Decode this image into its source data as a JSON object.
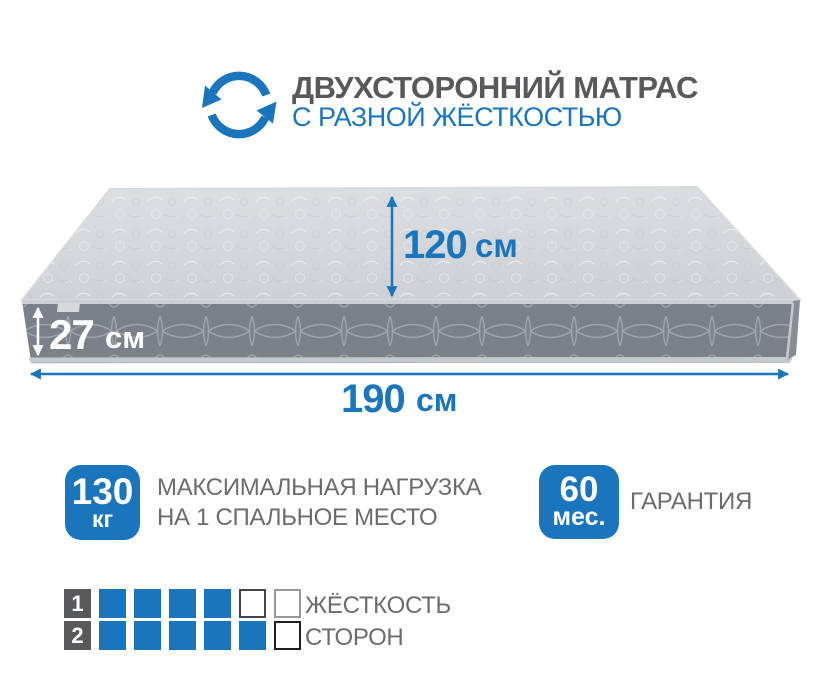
{
  "colors": {
    "accent_blue": "#1b75bc",
    "title_gray": "#58595b",
    "text_gray": "#6b6c6e",
    "mattress_top": "#d3d6da",
    "mattress_side": "#7c8089",
    "number_cell_bg": "#58595b"
  },
  "header": {
    "icon": "rotate-two-sided-icon",
    "title": "ДВУХСТОРОННИЙ МАТРАС",
    "subtitle": "С РАЗНОЙ ЖЁСТКОСТЬЮ"
  },
  "mattress": {
    "width_label": {
      "value": "120",
      "unit": "см"
    },
    "height_label": {
      "value": "27",
      "unit": "см"
    },
    "length_label": {
      "value": "190",
      "unit": "см"
    }
  },
  "features": [
    {
      "badge_value": "130",
      "badge_unit": "кг",
      "label_line1": "МАКСИМАЛЬНАЯ НАГРУЗКА",
      "label_line2": "НА 1 СПАЛЬНОЕ МЕСТО"
    },
    {
      "badge_value": "60",
      "badge_unit": "мес.",
      "label_line1": "ГАРАНТИЯ"
    }
  ],
  "firmness_scale": {
    "rows": [
      {
        "number": "1",
        "filled": 4,
        "total": 6,
        "cells": [
          "filled",
          "filled",
          "filled",
          "filled",
          "empty-dark",
          "empty-light"
        ]
      },
      {
        "number": "2",
        "filled": 5,
        "total": 6,
        "cells": [
          "filled",
          "filled",
          "filled",
          "filled",
          "filled",
          "empty-darkest"
        ]
      }
    ],
    "label_line1": "ЖЁСТКОСТЬ",
    "label_line2": "СТОРОН"
  }
}
